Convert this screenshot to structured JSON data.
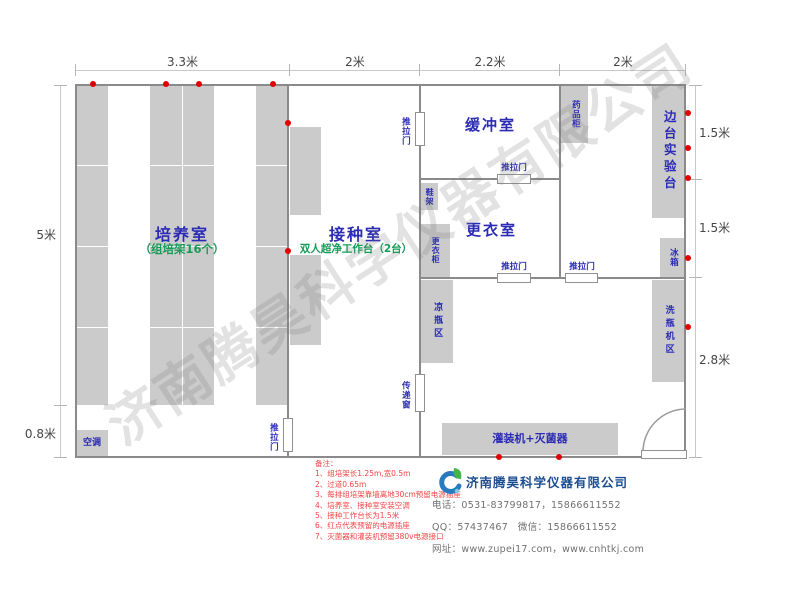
{
  "watermark": "济南腾昊科学仪器有限公司",
  "dims": {
    "top": [
      "3.3米",
      "2米",
      "2.2米",
      "2米"
    ],
    "left_5m": "5米",
    "left_08m": "0.8米",
    "right_15a": "1.5米",
    "right_15b": "1.5米",
    "right_28m": "2.8米"
  },
  "rooms": {
    "culture_name": "培养室",
    "culture_sub": "（组培架16个）",
    "inoculation_name": "接种室",
    "inoculation_sub": "双人超净工作台（2台）",
    "buffer_name": "缓冲室",
    "changing_name": "更衣室"
  },
  "labels": {
    "sliding_door": "推拉门",
    "pass_window": "传递窗",
    "shoe_rack": "鞋架",
    "wardrobe": "更衣柜",
    "medicine_cabinet": "药品柜",
    "side_bench": "边台实验台",
    "fridge": "冰箱",
    "cool_bottle_area": "凉瓶区",
    "bottle_washer_area": "洗瓶机区",
    "filler_sterilizer": "灌装机+灭菌器",
    "air_conditioner": "空调"
  },
  "notes": {
    "title": "备注：",
    "items": [
      "1、组培架长1.25m,宽0.5m",
      "2、过道0.65m",
      "3、每排组培架靠墙离地30cm预留电源插座",
      "4、培养室、接种室安装空调",
      "5、接种工作台长为1.5米",
      "6、红点代表预留的电源插座",
      "7、灭菌器和灌装机预留380v电源接口"
    ]
  },
  "company": {
    "name": "济南腾昊科学仪器有限公司",
    "phone": "电话：0531-83799817，15866611552",
    "qq_wechat": "QQ：57437467　微信：15866611552",
    "website": "网址：www.zupei17.com，www.cnhtkj.com"
  },
  "colors": {
    "room_label_blue": "#2b2bb4",
    "sub_label_green": "#169b57",
    "red_dot": "#e00000",
    "note_red": "#f04545",
    "furniture_gray": "#cbcbcb",
    "wall_gray": "#8a8a8a",
    "company_blue": "#1d4e91"
  }
}
